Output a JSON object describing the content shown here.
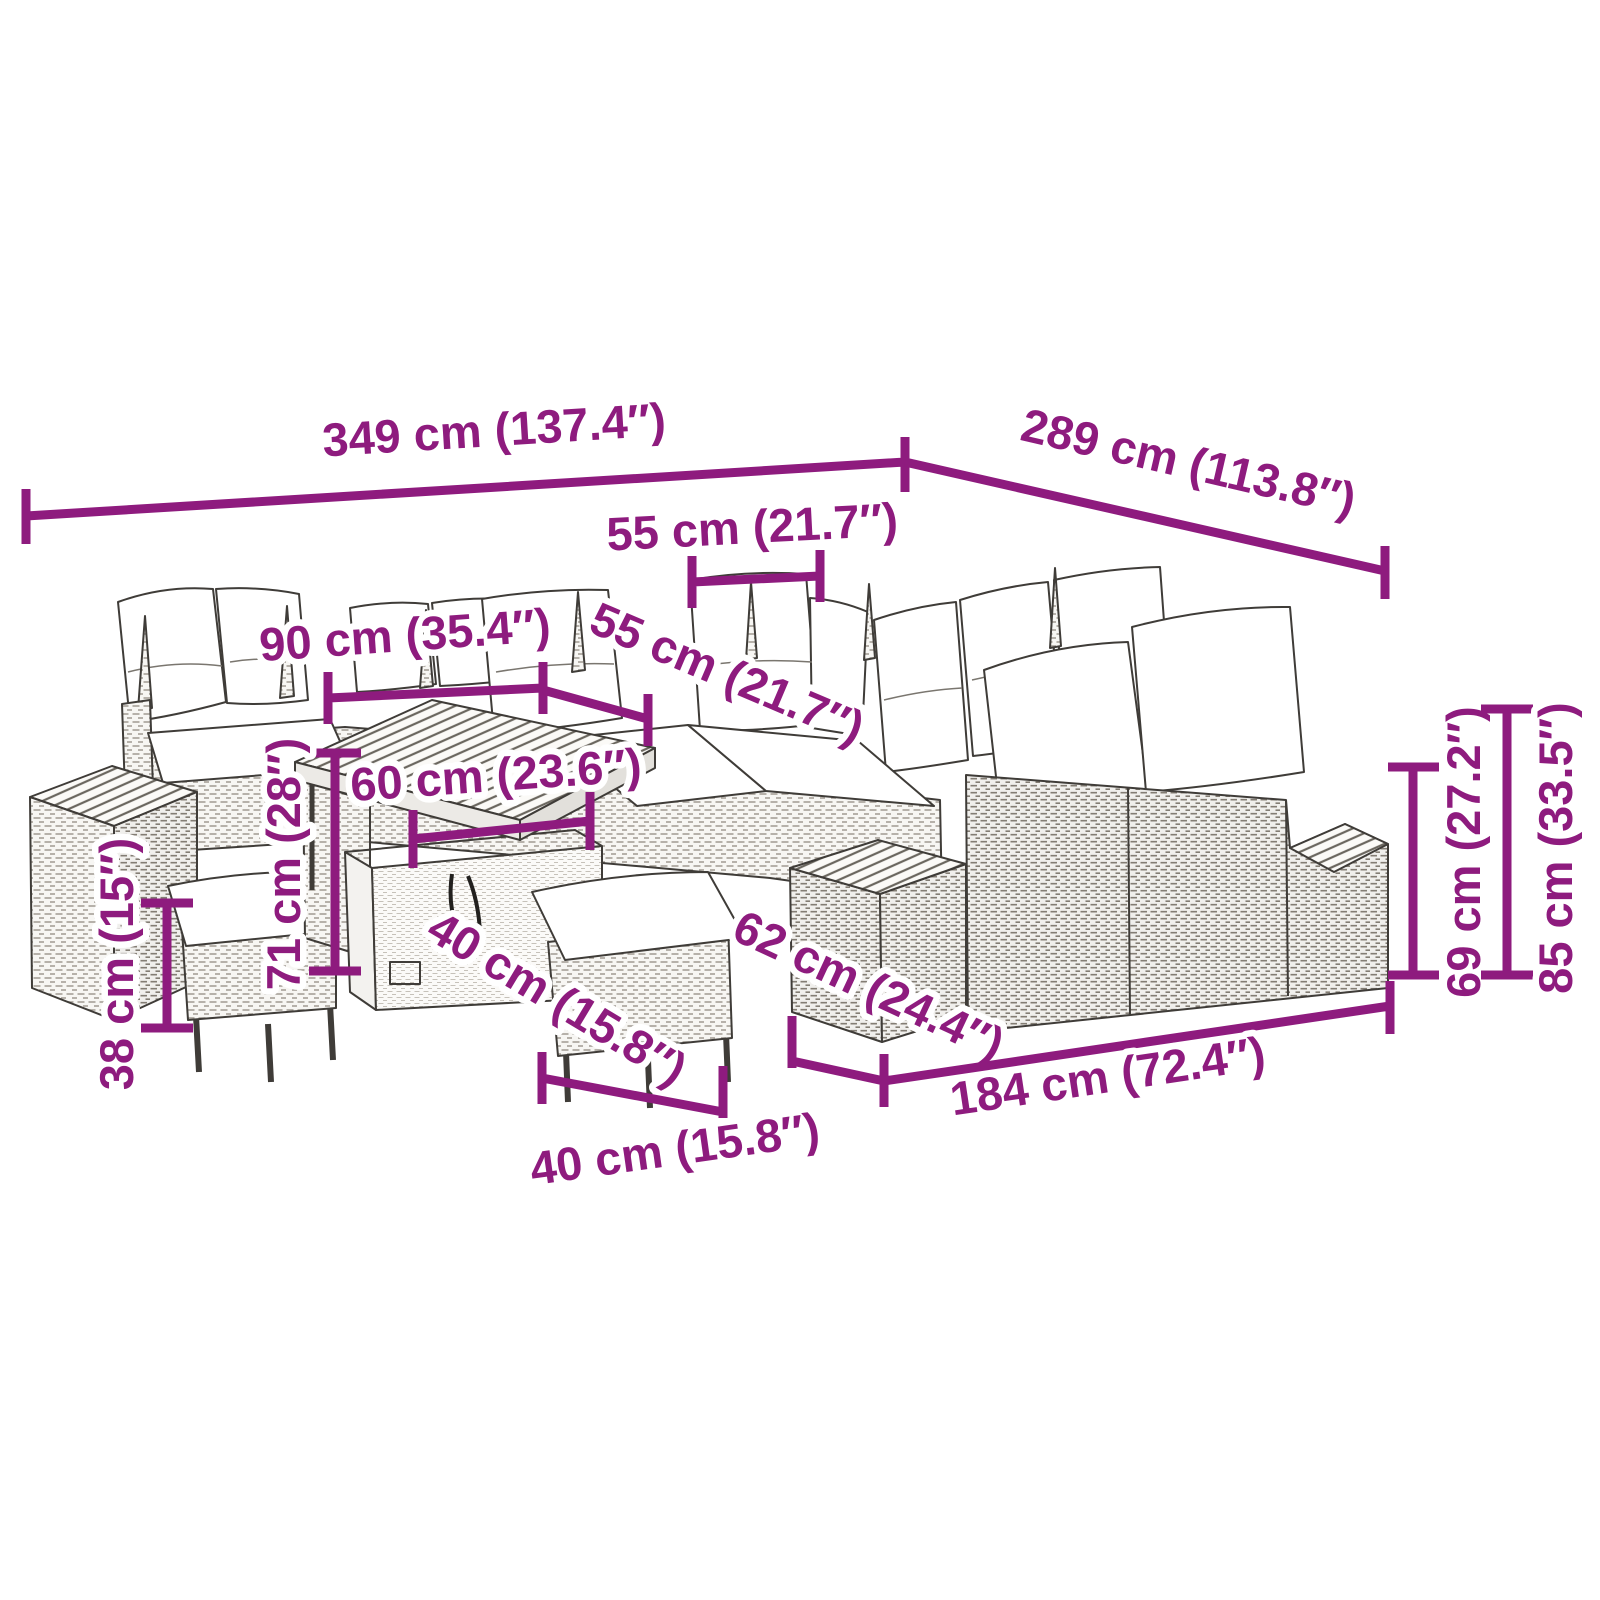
{
  "diagram": {
    "kind": "furniture-dimension-diagram",
    "subject": "garden lounge set with cushions, tables and stools"
  },
  "colors": {
    "dimension_accent": "#8E1B7E",
    "background": "#FFFFFF",
    "sketch_line": "#3F3C38",
    "cushion_fill": "#FFFFFF"
  },
  "dimensions": {
    "total_width": "349 cm (137.4″)",
    "total_depth": "289 cm (113.8″)",
    "seat_width_top": "55 cm (21.7″)",
    "sofa_section_width": "90 cm (35.4″)",
    "seat_width_corner": "55 cm (21.7″)",
    "table_width": "60 cm (23.6″)",
    "table_height": "71 cm (28″)",
    "stool_height": "38 cm (15″)",
    "box_depth": "40 cm (15.8″)",
    "stool_width": "40 cm (15.8″)",
    "bench_depth": "62 cm (24.4″)",
    "bench_width": "184 cm (72.4″)",
    "seat_back_height": "69 cm (27.2″)",
    "total_height": "85 cm (33.5″)"
  }
}
